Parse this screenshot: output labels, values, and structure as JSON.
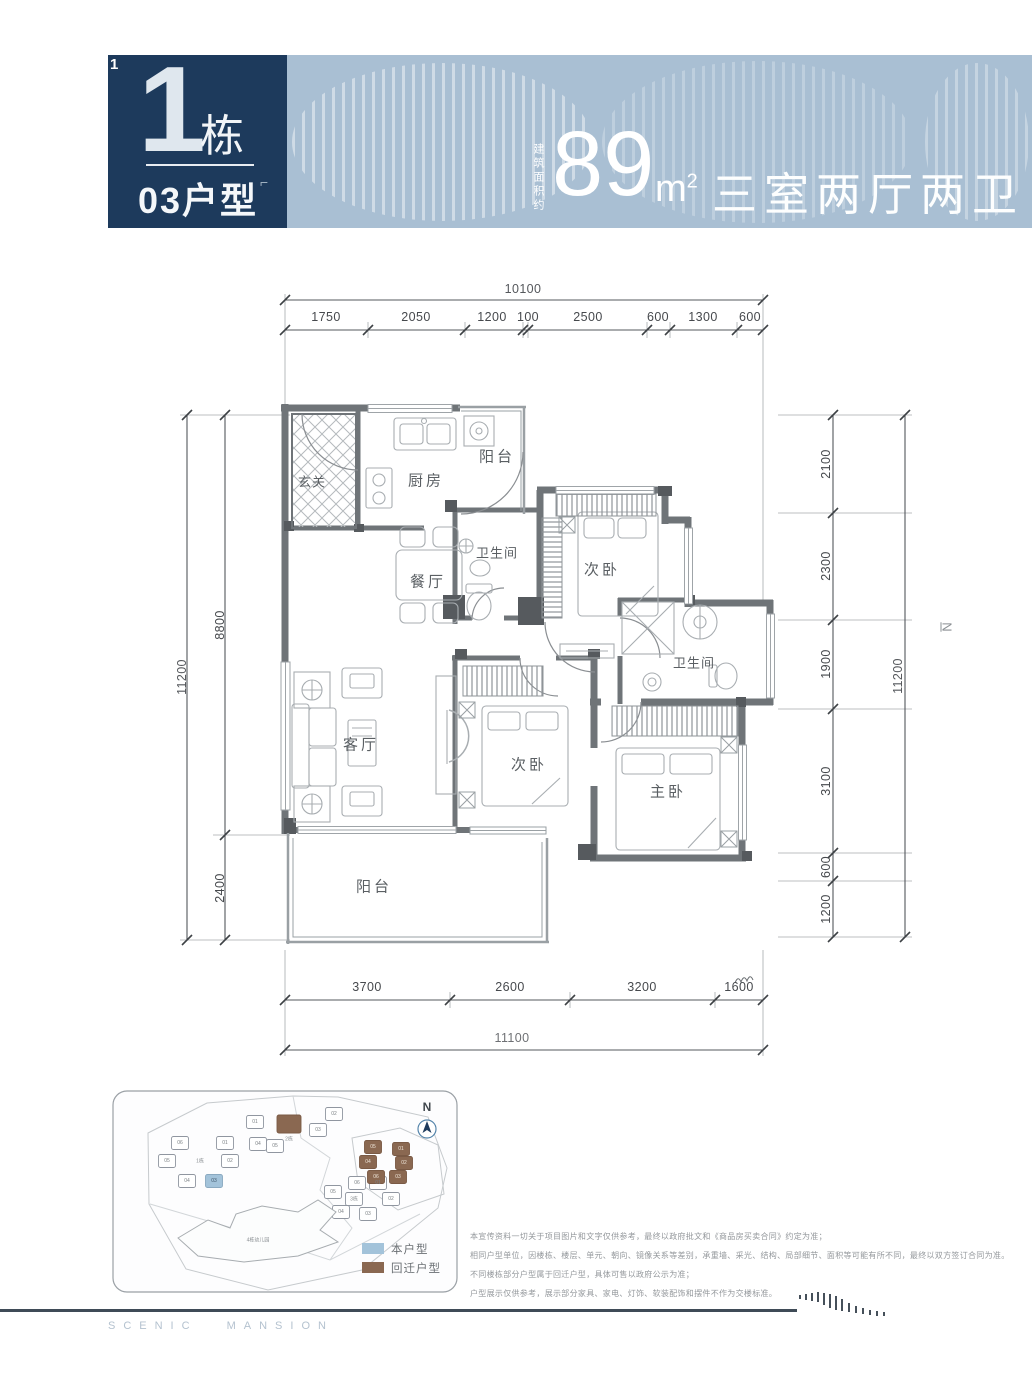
{
  "colors": {
    "navy": "#1d3a5c",
    "band_blue": "#a9bfd3",
    "wall_gray": "#6f7478",
    "legend_self_blue": "#a3c3da",
    "legend_relocation_brown": "#8a6851",
    "footer_rule": "#3f4b57"
  },
  "header": {
    "corner_mark": "1",
    "building_number": "1",
    "building_suffix": "栋",
    "unit_label": "03户型",
    "artifact_mark": "⌐",
    "area_prefix": "建筑面积约",
    "area_value": "89",
    "area_unit_base": "m",
    "area_unit_exp": "2",
    "layout_text": "三室两厅两卫"
  },
  "floor_plan": {
    "rooms": {
      "entry": "玄关",
      "kitchen": "厨房",
      "balcony_top": "阳台",
      "bathroom_1": "卫生间",
      "dining": "餐厅",
      "bedroom_2": "次卧",
      "bathroom_2": "卫生间",
      "living": "客厅",
      "bedroom_3": "次卧",
      "master": "主卧",
      "balcony_bottom": "阳台"
    },
    "dimensions": {
      "top_total": "10100",
      "top_segments": [
        "1750",
        "2050",
        "1200",
        "100",
        "2500",
        "600",
        "1300",
        "600"
      ],
      "left_total": "11200",
      "left_segments": [
        "8800",
        "2400"
      ],
      "right_total": "11200",
      "right_segments": [
        "2100",
        "2300",
        "1900",
        "3100",
        "600",
        "1200"
      ],
      "bottom_total": "11100",
      "bottom_segments": [
        "3700",
        "2600",
        "3200",
        "1600"
      ],
      "side_mark": "N"
    }
  },
  "site_plan": {
    "north_label": "N",
    "clusters": [
      {
        "name": "1栋",
        "units": [
          "01",
          "02",
          "03",
          "04",
          "05",
          "06"
        ]
      },
      {
        "name": "2栋",
        "units": [
          "01",
          "02",
          "03",
          "04",
          "05"
        ]
      },
      {
        "name": "3栋",
        "units": [
          "01",
          "02",
          "03",
          "04",
          "05",
          "06"
        ]
      },
      {
        "name": "5栋",
        "units": [
          "01",
          "02",
          "03",
          "04",
          "05",
          "06"
        ]
      }
    ],
    "kindergarten_label": "4栋幼儿园",
    "legend": [
      {
        "label": "本户型",
        "color": "#a3c3da"
      },
      {
        "label": "回迁户型",
        "color": "#8a6851"
      }
    ]
  },
  "disclaimer": {
    "lines": [
      "本宣传资料一切关于项目图片和文字仅供参考，最终以政府批文和《商品房买卖合同》约定为准；",
      "相同户型单位，因楼栋、楼层、单元、朝向、镜像关系等差别，承重墙、采光、结构、局部细节、面积等可能有所不同，最终以双方签订合同为准。",
      "不同楼栋部分户型属于回迁户型，具体可售以政府公示为准；",
      "户型展示仅供参考，展示部分家具、家电、灯饰、软装配饰和摆件不作为交楼标准。"
    ]
  },
  "footer": {
    "brand": "SCENIC MANSION"
  }
}
